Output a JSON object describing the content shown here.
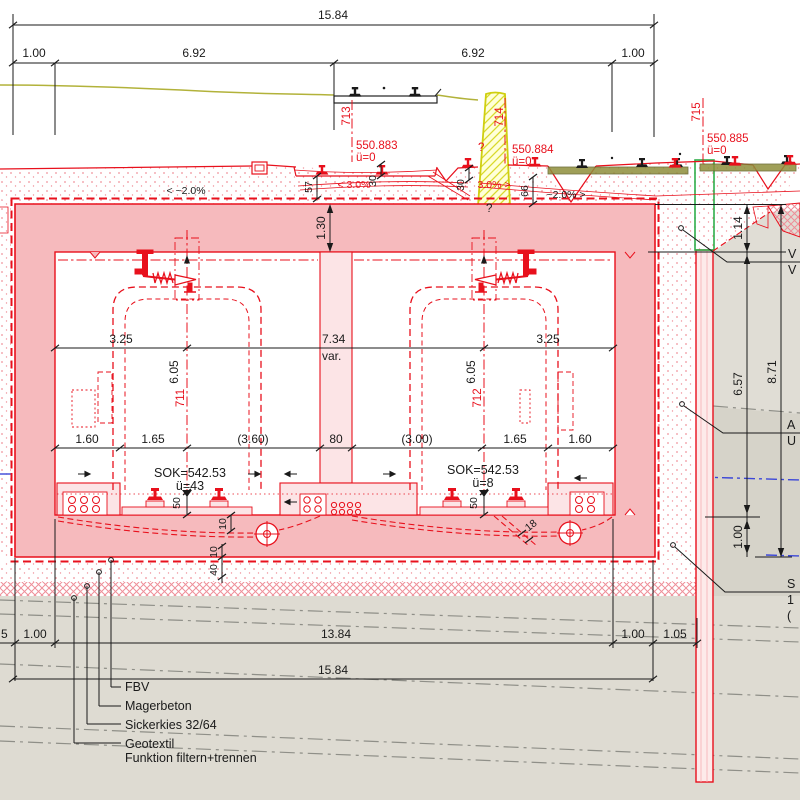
{
  "dims": {
    "total_top": "15.84",
    "t1": "1.00",
    "t2": "6.92",
    "t3": "6.92",
    "t4": "1.00",
    "w_left": "3.25",
    "w_center": "7.34",
    "w_var": "var.",
    "w_right": "3.25",
    "h_left": "6.05",
    "h_right": "6.05",
    "roof": "1.30",
    "d1": "1.60",
    "d2": "1.65",
    "d3": "(3.60)",
    "d4": "80",
    "d5": "(3.00)",
    "d6": "1.65",
    "d7": "1.60",
    "s57": "57",
    "s30a": "30",
    "s30b": "30",
    "s66": "66",
    "r114": "1.14",
    "r657": "6.57",
    "r871": "8.71",
    "r100": "1.00",
    "b0": "5",
    "b1": "1.00",
    "b2": "13.84",
    "b3": "1.00",
    "b4": "1.05",
    "total_bottom": "15.84",
    "f50l": "50",
    "f50r": "50",
    "f10a": "10",
    "f10b": "10",
    "f40": "40",
    "f18": "18"
  },
  "axes": {
    "a711": "711",
    "a712": "712",
    "a713": "713",
    "a714": "714",
    "a715": "715"
  },
  "levels": {
    "p713": "550.883",
    "p713u": "ü=0",
    "p714": "550.884",
    "p714u": "ü=0",
    "p715": "550.885",
    "p715u": "ü=0",
    "sokl": "SOK=542.53",
    "soklu": "ü=43",
    "sokr": "SOK=542.53",
    "sokru": "ü=8"
  },
  "slopes": {
    "left": "< ~2.0%",
    "mid_left": "< 3.0%",
    "mid_right": "3.0% >",
    "right": "~2.0% >"
  },
  "annotations": {
    "fbv": "FBV",
    "magerbeton": "Magerbeton",
    "sickerkies": "Sickerkies 32/64",
    "geotextil_1": "Geotextil",
    "geotextil_2": "Funktion filtern+trennen",
    "q1": "?",
    "q2": "?"
  },
  "clipped_right": {
    "r1a": "V",
    "r1b": "V",
    "r2a": "A",
    "r2b": "U",
    "r3a": "S",
    "r3b": "1",
    "r3c": "("
  },
  "colors": {
    "red": "#e8101c",
    "pink": "#f6babd",
    "pink_light": "#fce4e6",
    "olive": "#b2b23a",
    "yellow": "#d6d600",
    "green": "#2fae4a",
    "ground": "#dedbd2",
    "blue": "#3b46d8"
  }
}
